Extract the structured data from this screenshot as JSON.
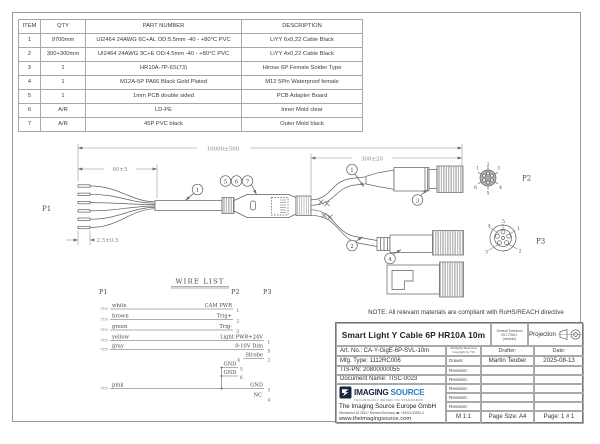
{
  "bom": {
    "headers": [
      "ITEM",
      "QTY",
      "PART NUMBER",
      "DESCRIPTION"
    ],
    "rows": [
      [
        "1",
        "9700mm",
        "UI2464 24AWG 6C+AL OD:5.5mm -40 - +80°C PVC",
        "LiYY 6x0,22 Cable Black"
      ],
      [
        "2",
        "300+300mm",
        "UI2464 24AWG 3C+E OD:4.5mm -40 - +80°C PVC",
        "LiYY 4x0,22 Cable Black"
      ],
      [
        "3",
        "1",
        "HR10A-7P-6S(73)",
        "Hirose 6P Female Solder Type"
      ],
      [
        "4",
        "1",
        "M12A-5P PA66 Black Gold Plated",
        "M12 5Pin Waterproof female"
      ],
      [
        "5",
        "1",
        "1mm PCB double sided",
        "PCB Adapter Board"
      ],
      [
        "6",
        "A/R",
        "LD-PE",
        "Inner Mold clear"
      ],
      [
        "7",
        "A/R",
        "45P PVC black",
        "Outer Mold black"
      ]
    ]
  },
  "drawing": {
    "dims": {
      "overall": "10000±500",
      "strip": "60±5",
      "tin": "2.5±0.5",
      "branch": "300±20"
    },
    "labels": {
      "p1": "P1",
      "p2": "P2",
      "p3": "P3"
    },
    "balloons": {
      "main_cable": "1",
      "top_branch": "1",
      "bottom_branch": "2",
      "hirose": "3",
      "m12": "4",
      "mold": [
        "5",
        "6",
        "7"
      ]
    },
    "p2_pins": [
      "1",
      "2",
      "3",
      "4",
      "5",
      "6"
    ],
    "p3_pins": [
      "1",
      "2",
      "3",
      "4",
      "5"
    ]
  },
  "wire_list": {
    "title": "WIRE LIST",
    "col_headers": [
      "P1",
      "P2",
      "P3"
    ],
    "rows": [
      {
        "tin": "TIN",
        "color": "white",
        "signal": "CAM PWR",
        "pin": "1"
      },
      {
        "tin": "TIN",
        "color": "brown",
        "signal": "Trig+",
        "pin": "2"
      },
      {
        "tin": "TIN",
        "color": "green",
        "signal": "Trig-",
        "pin": "3"
      },
      {
        "tin": "TIN",
        "color": "yellow",
        "signal": "Light PWR+24V",
        "pin": "1"
      },
      {
        "tin": "TIN",
        "color": "gray",
        "signal": "0-10V Dim",
        "pin": "5"
      },
      {
        "left_pin": "4",
        "signal": "Strobe",
        "pin": "2"
      },
      {
        "signal": "GND",
        "pin": "5"
      },
      {
        "signal": "GND",
        "pin": "6"
      },
      {
        "tin": "TIN",
        "color": "pink",
        "signal": "GND",
        "pin": "3"
      },
      {
        "signal": "NC",
        "pin": "4"
      }
    ]
  },
  "note": "NOTE: All relevant materials are compliant with RoHS/REACH directive",
  "title_block": {
    "title": "Smart Light Y Cable 6P HR10A 10m",
    "tolerance_line1": "General Tolerance",
    "tolerance_line2": "ISO 2768-1",
    "tolerance_line3": "(medium)",
    "projection_label": "Projection",
    "art_no": "Art. No.: CA-Y-GigE-6P-SVL-10m",
    "copyright_line1": "All Rights Reserved",
    "copyright_line2": "Copyright by TIS",
    "drafter_label": "Drafter:",
    "date_label": "Date:",
    "drawn_label": "Drawn:",
    "revision_label": "Revision:",
    "revision_row_count": 5,
    "mfg_type": "Mfg. Type: 1112RC006",
    "tis_pn": "TIS-PN: 20800000055",
    "doc_name": "Document Name: TISC-0023",
    "drafter": "Martin Teuber",
    "date": "2025-08-13",
    "logo_text1": "IMAGING",
    "logo_text2": "SOURCE",
    "logo_tagline": "TECHNOLOGY BASED ON STANDARDS",
    "company": "The Imaging Source Europe GmbH",
    "address": "Überseetor 18 28217 Bremen/Germany ☎ +49421/33591-0",
    "website": "www.theimagingsource.com",
    "scale": "M 1:1",
    "page_size": "Page Size: A4",
    "page": "Page:  1 # 1"
  },
  "colors": {
    "line": "#5f5f5f",
    "dim_text": "#8a8a8a",
    "text": "#4a4a4a",
    "logo_dark": "#19253f",
    "logo_blue": "#2a80c0"
  }
}
